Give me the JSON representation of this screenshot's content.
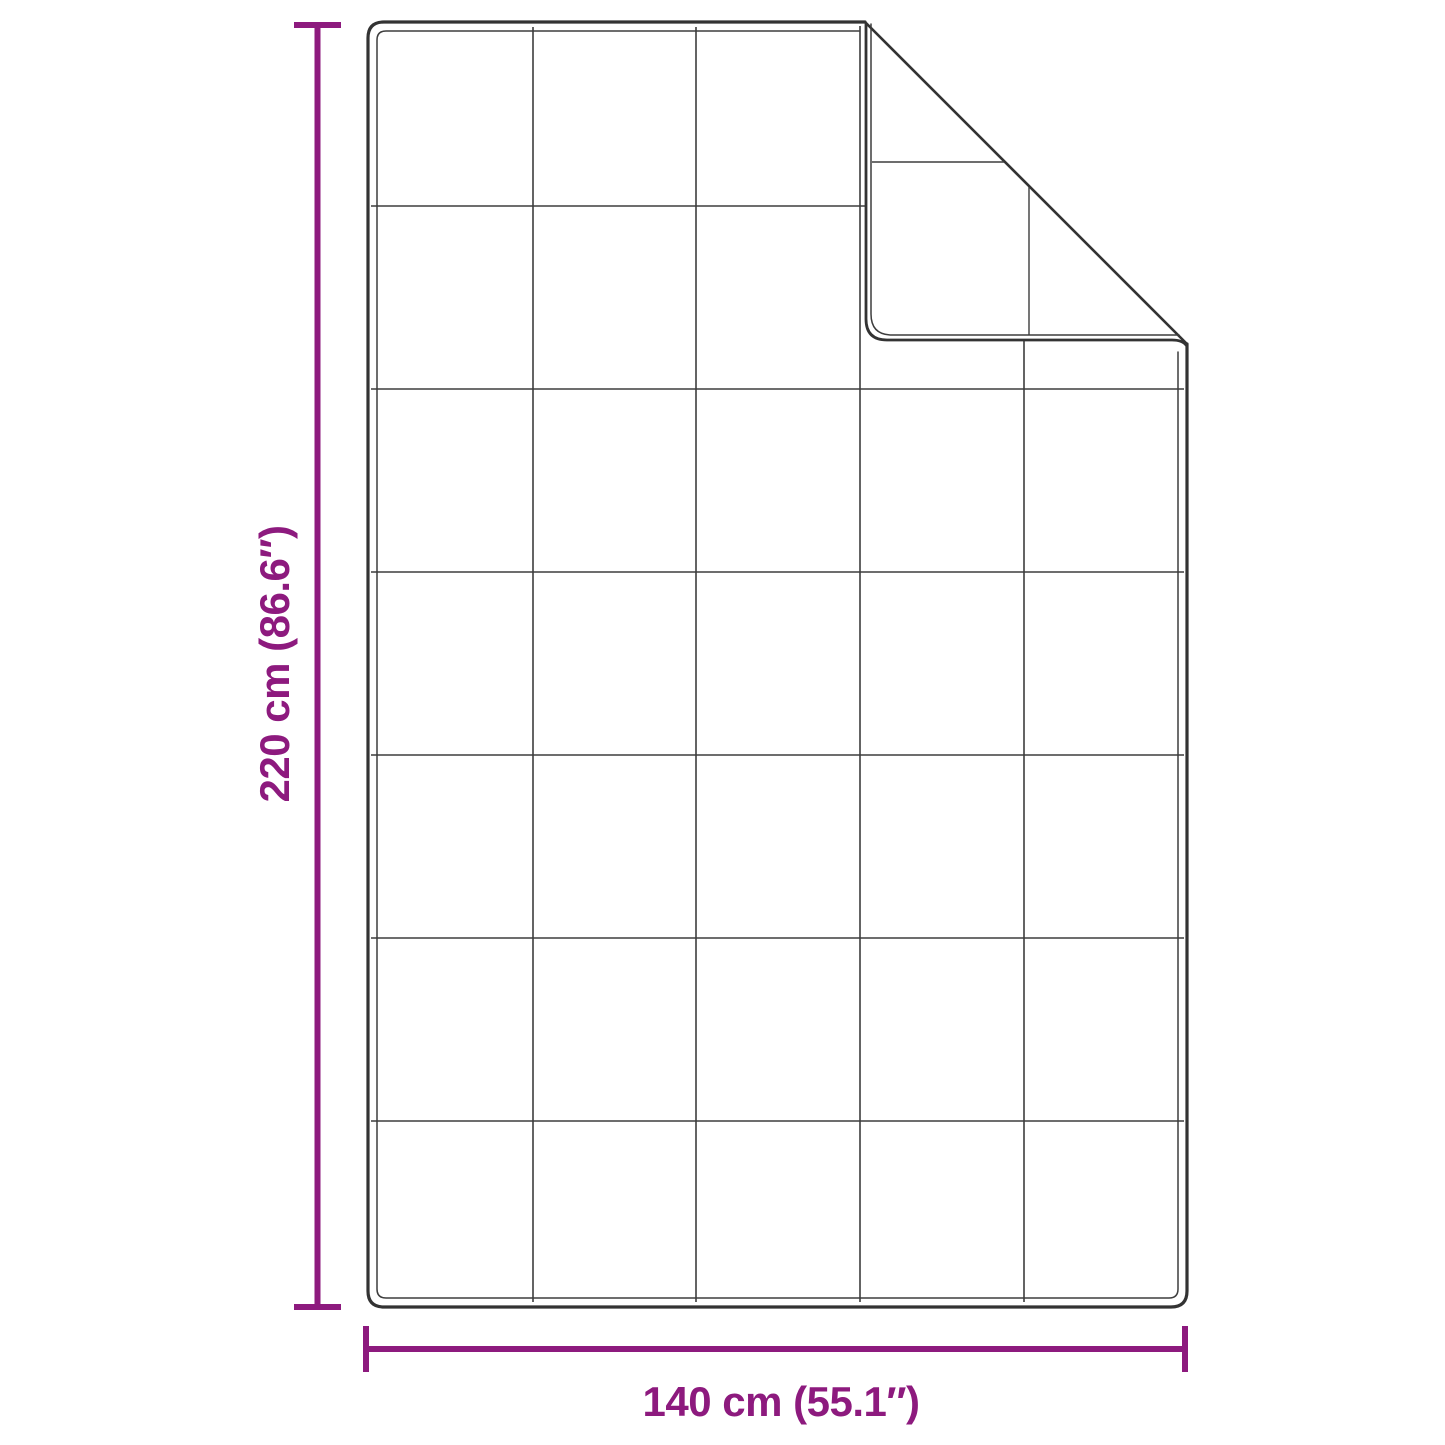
{
  "page": {
    "background": "#ffffff"
  },
  "colors": {
    "background": "#ffffff",
    "accent": "#8d1a7e",
    "outline": "#333333",
    "grid": "#3d3d3d"
  },
  "diagram": {
    "kind": "blanket-dimension-diagram",
    "height_dimension": {
      "label": "220 cm (86.6″)",
      "value_cm": 220,
      "value_in": 86.6
    },
    "width_dimension": {
      "label": "140 cm (55.1″)",
      "value_cm": 140,
      "value_in": 55.1
    },
    "quilt_grid": {
      "rows": 7,
      "columns": 5
    }
  }
}
